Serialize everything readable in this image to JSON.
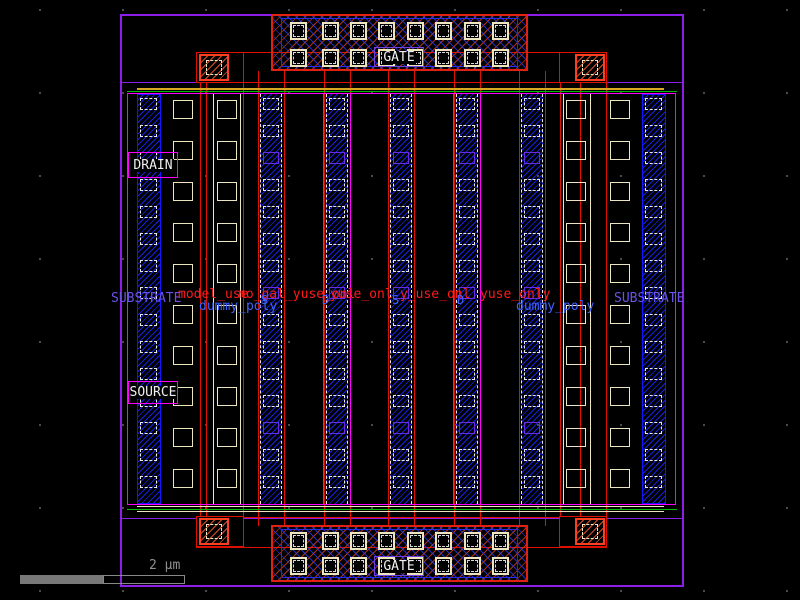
{
  "view": {
    "type": "ic-layout-viewer-viewport",
    "scale_label": "2 µm"
  },
  "labels": {
    "gate_top": "GATE",
    "gate_bottom": "GATE",
    "drain": "DRAIN",
    "source": "SOURCE",
    "substrate_left": "SUBSTRATE",
    "substrate_right": "SUBSTRATE",
    "dummy_poly_left": "dummy_poly",
    "dummy_poly_right": "dummy_poly",
    "finger_letters": [
      "S",
      "D",
      "S",
      "D"
    ],
    "annotations_red": [
      "model_use",
      "no_gal_yuse_onl",
      "yuse_onl",
      "y_use_onl",
      "yuse_only"
    ]
  },
  "colors": {
    "background": "#000000",
    "boundary_purple": "#8b1fe8",
    "well_magenta": "#ff00ff",
    "poly_red": "#e01000",
    "metal_blue": "#1515ff",
    "diffusion_green": "#00bb00",
    "implant_yellow": "#d8a820",
    "contact_ivory": "#ece5c0",
    "via_orange": "#ff4020",
    "text_blue": "#3f63ff",
    "text_purple": "#6a52e8",
    "annotation_red": "#ff1a1a",
    "scalebar_gray": "#8a8a8a"
  }
}
